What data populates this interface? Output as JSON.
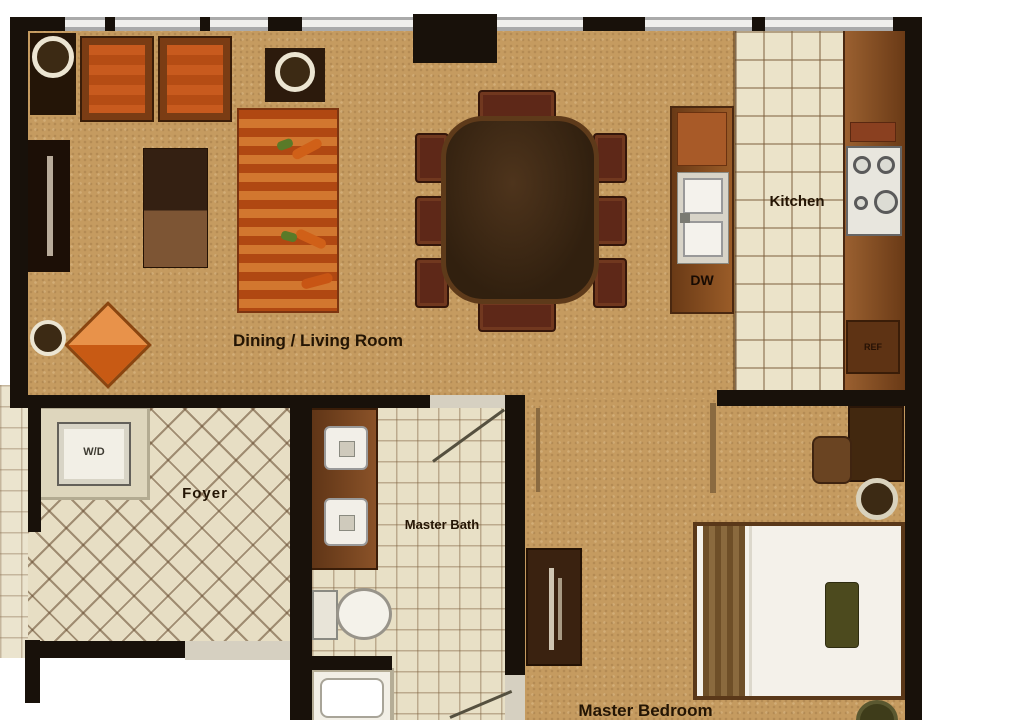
{
  "plan": {
    "rooms": {
      "dining_living": {
        "label": "Dining / Living Room"
      },
      "kitchen": {
        "label": "Kitchen"
      },
      "foyer": {
        "label": "Foyer"
      },
      "master_bath": {
        "label": "Master Bath"
      },
      "master_bedroom": {
        "label": "Master Bedroom"
      }
    },
    "appliances": {
      "washer_dryer": {
        "label": "W/D"
      },
      "dishwasher": {
        "label": "DW"
      },
      "refrigerator": {
        "label": "REF"
      }
    },
    "colors": {
      "wall": "#18110a",
      "carpet": "#c59b60",
      "kitchen_tile": "#ebe3c9",
      "bath_tile": "#e8e0c6",
      "foyer_tile": "#e7dec4",
      "counter_wood": "#8a5526",
      "accent_orange": "#c85a1e",
      "dining_table_wood": "#3b2817"
    }
  }
}
